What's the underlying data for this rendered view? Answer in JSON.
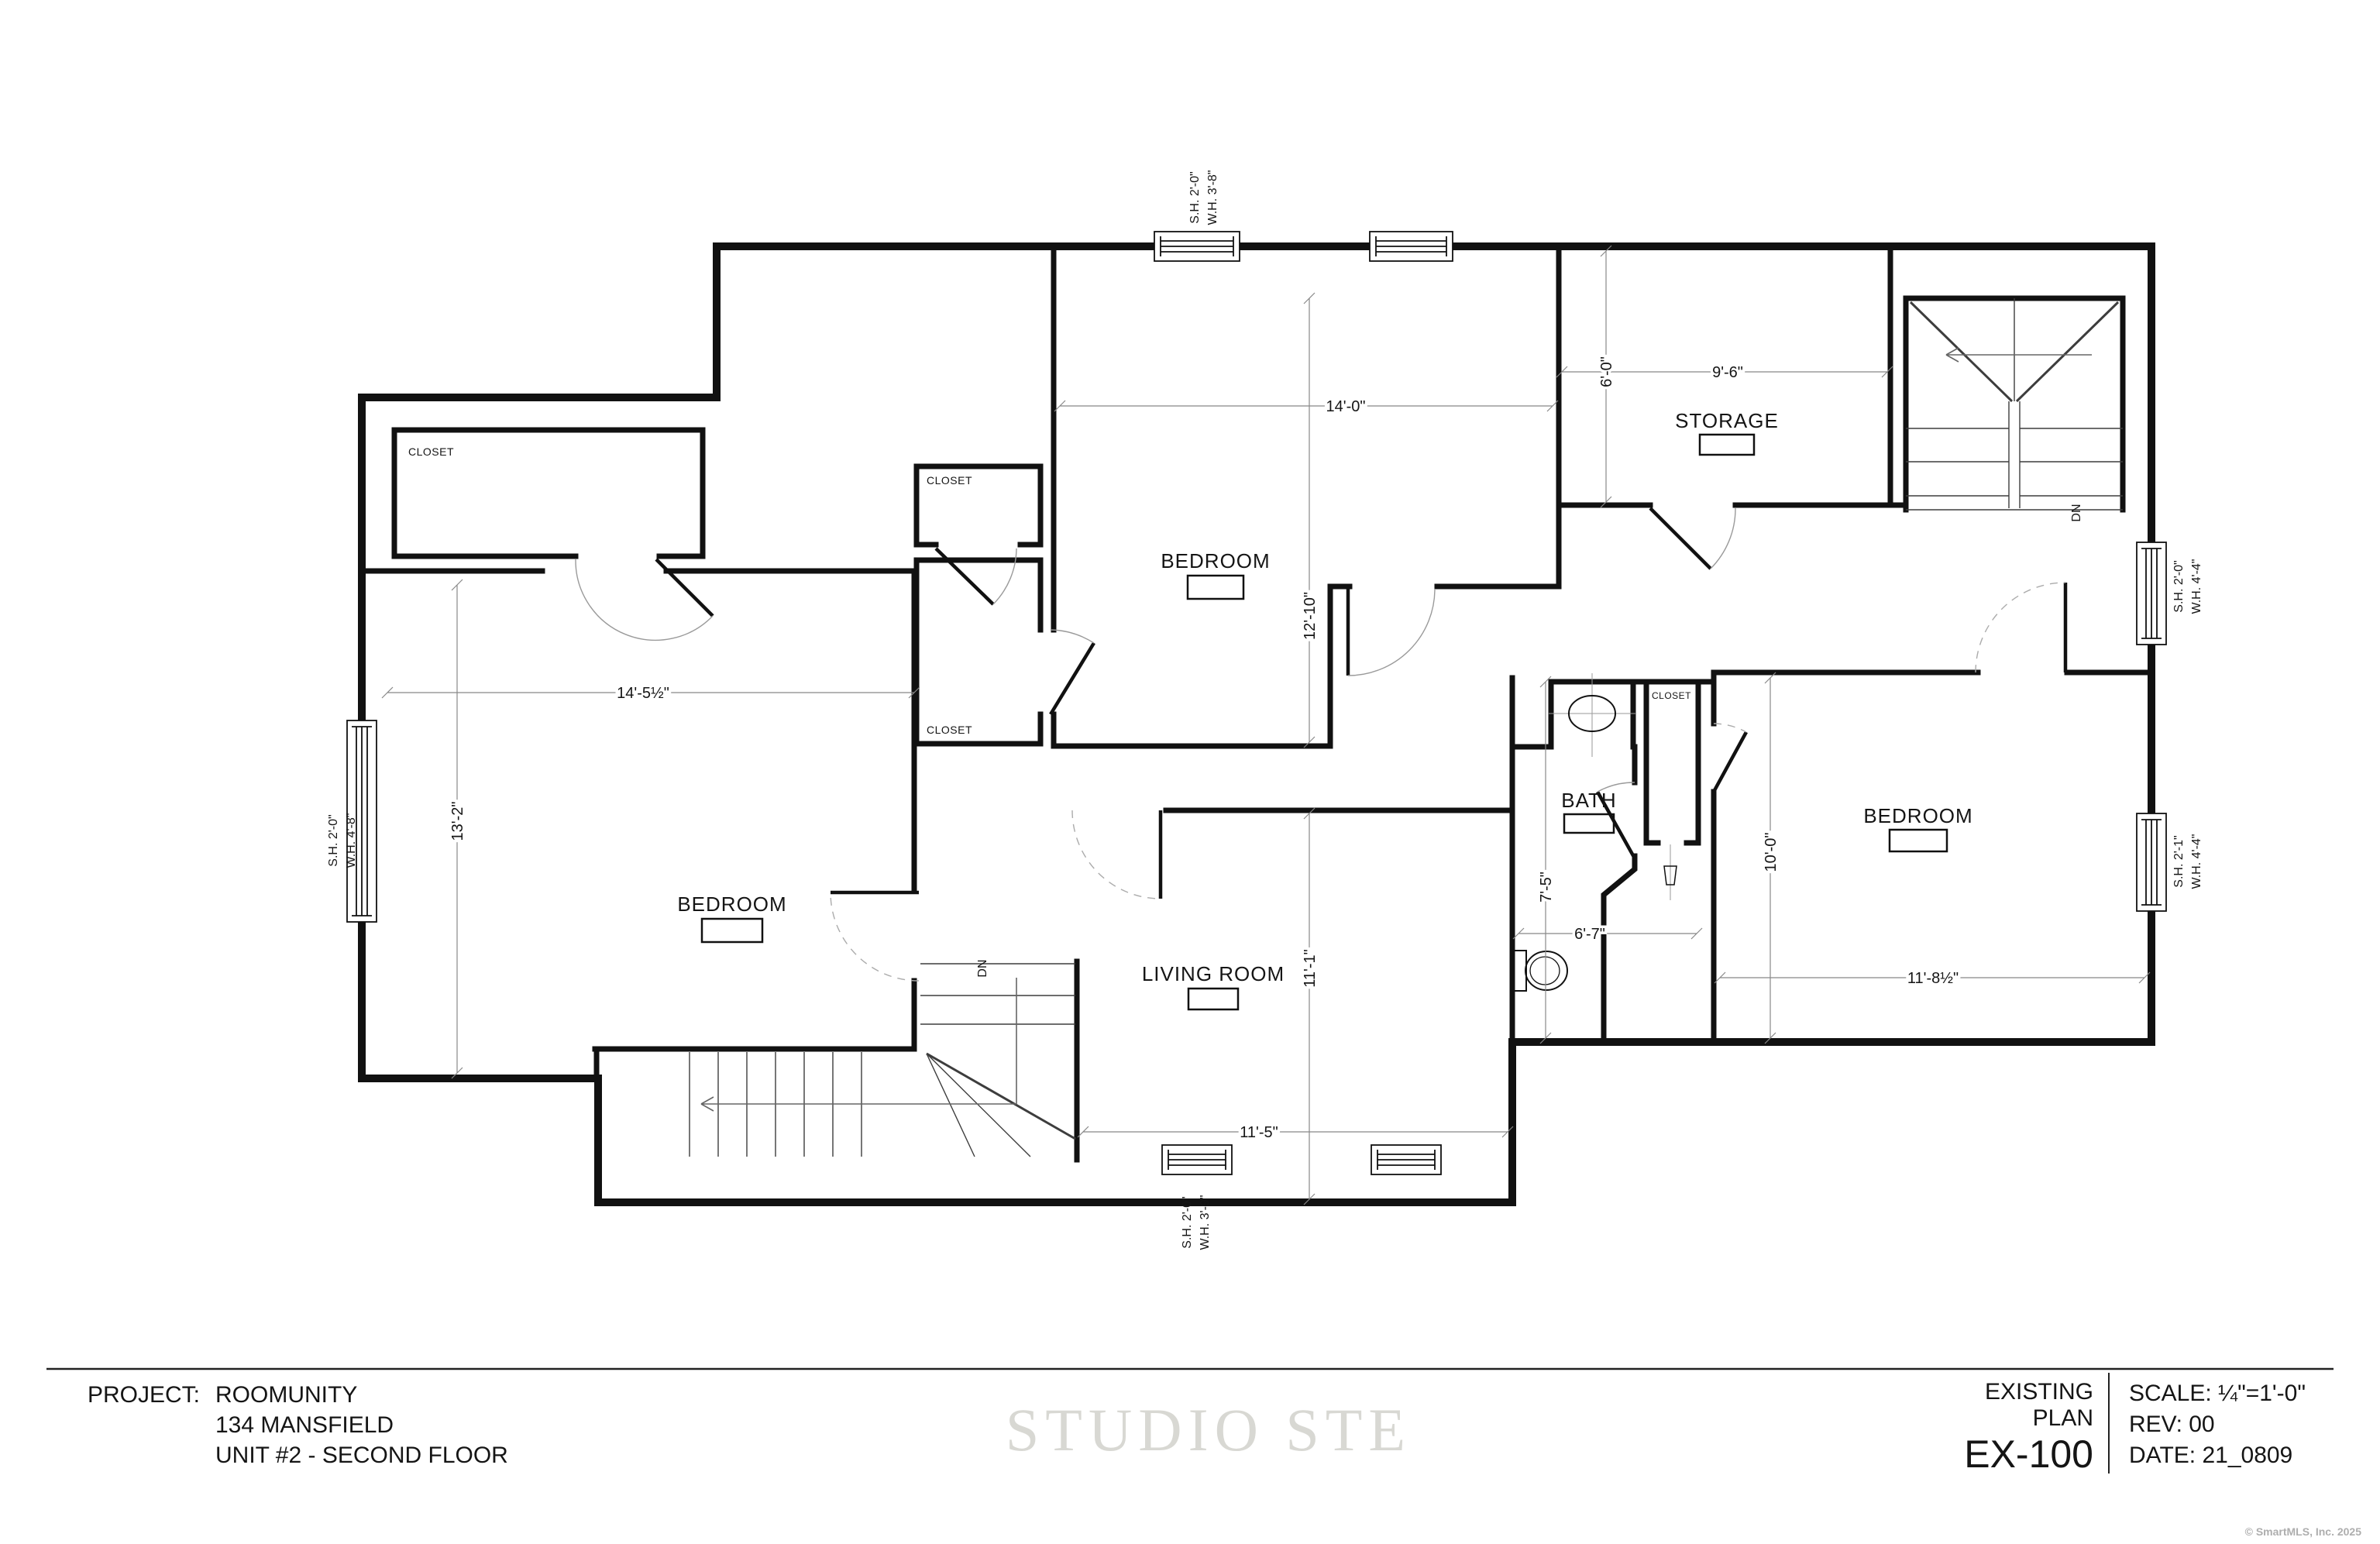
{
  "title_block": {
    "project_label": "PROJECT:",
    "project_name": "ROOMUNITY",
    "project_address": "134 MANSFIELD",
    "project_unit": "UNIT #2 - SECOND FLOOR",
    "plan_name_line1": "EXISTING",
    "plan_name_line2": "PLAN",
    "sheet_number": "EX-100",
    "scale": "SCALE: ¼\"=1'-0\"",
    "revision": "REV:  00",
    "date": "DATE: 21_0809"
  },
  "watermark": {
    "studio": "STUDIO STE",
    "copyright": "© SmartMLS, Inc.  2025"
  },
  "rooms": {
    "bedroom_left": {
      "label": "BEDROOM",
      "width": "14'-5½\"",
      "depth": "13'-2\""
    },
    "bedroom_middle": {
      "label": "BEDROOM",
      "width": "14'-0\"",
      "depth": "12'-10\""
    },
    "bedroom_right": {
      "label": "BEDROOM",
      "width": "11'-8½\"",
      "depth": "10'-0\""
    },
    "living_room": {
      "label": "LIVING ROOM",
      "width": "11'-5\"",
      "depth": "11'-1\""
    },
    "bath": {
      "label": "BATH",
      "width": "6'-7\"",
      "depth": "7'-5\""
    },
    "storage": {
      "label": "STORAGE",
      "width": "9'-6\"",
      "depth": "6'-0\""
    },
    "closet": {
      "label": "CLOSET"
    },
    "stair": {
      "down_label": "DN"
    }
  },
  "windows": {
    "top": {
      "line1": "S.H. 2'-0\"",
      "line2": "W.H. 3'-8\""
    },
    "left": {
      "line1": "S.H. 2'-0\"",
      "line2": "W.H. 4'-8\""
    },
    "bottom": {
      "line1": "S.H. 2'-0\"",
      "line2": "W.H. 3'-9\""
    },
    "right_upper": {
      "line1": "S.H. 2'-0\"",
      "line2": "W.H. 4'-4\""
    },
    "right_lower": {
      "line1": "S.H. 2'-1\"",
      "line2": "W.H. 4'-4\""
    }
  }
}
